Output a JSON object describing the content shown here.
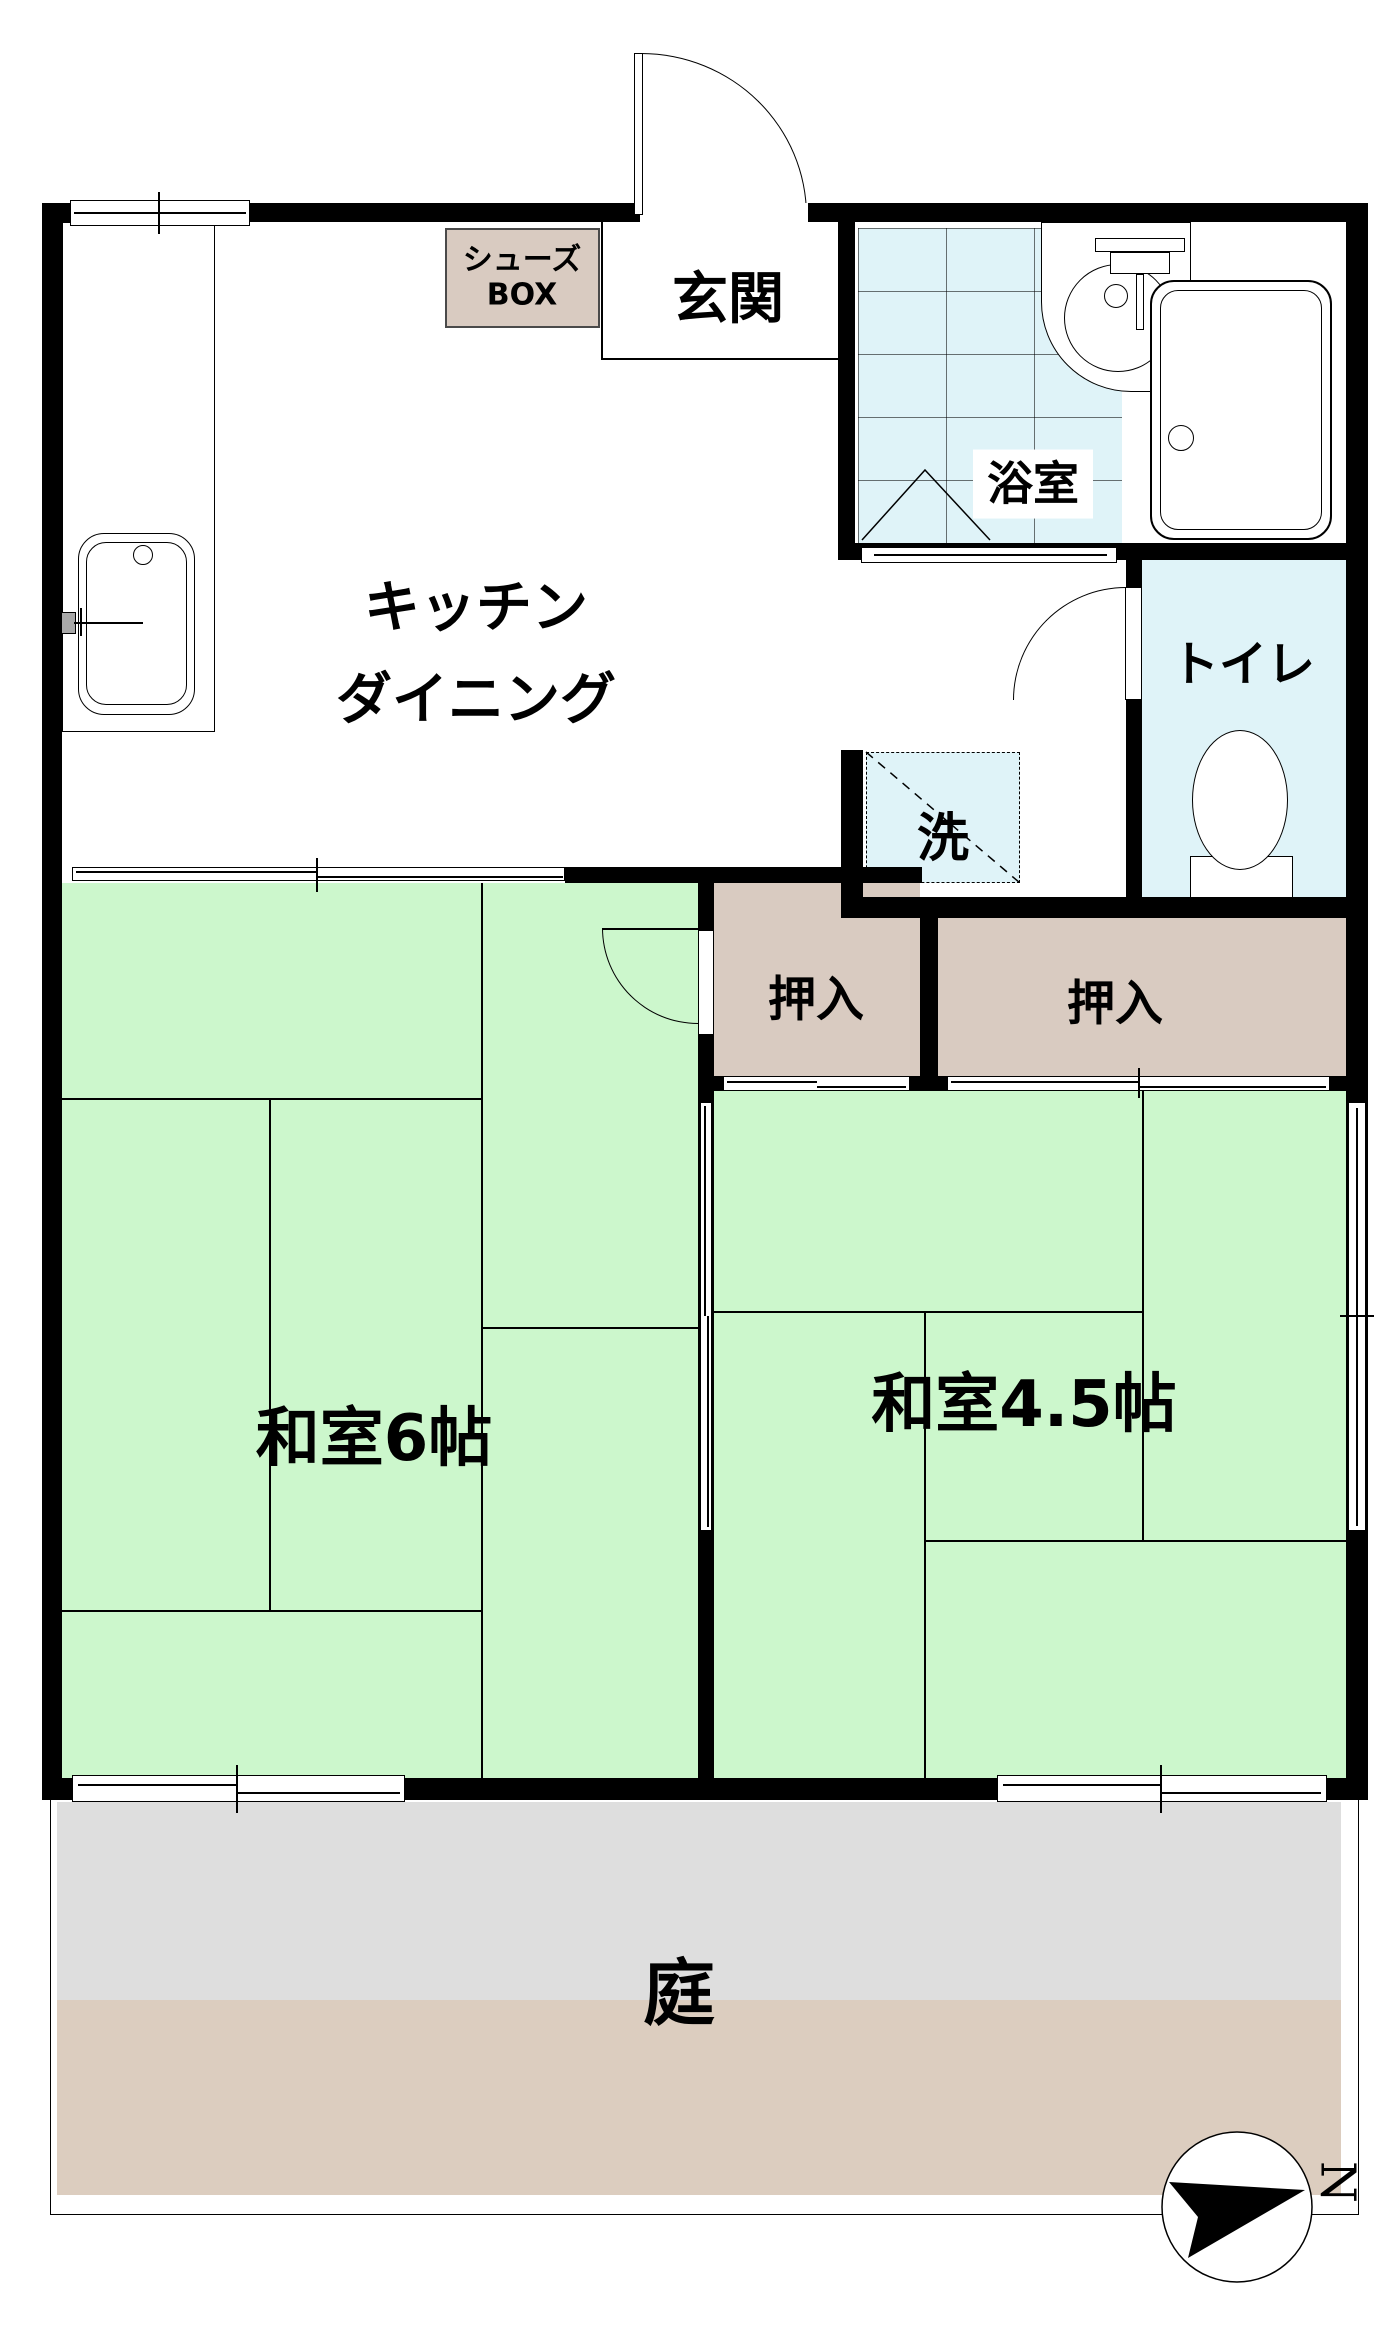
{
  "plan": {
    "rooms": {
      "genkan": {
        "label": "玄関"
      },
      "shoes_box": {
        "line1": "シューズ",
        "line2": "BOX"
      },
      "bathroom": {
        "label": "浴室"
      },
      "toilet": {
        "label": "トイレ"
      },
      "kitchen": {
        "line1": "キッチン",
        "line2": "ダイニング"
      },
      "laundry": {
        "label": "洗"
      },
      "closet_left": {
        "label": "押入"
      },
      "closet_right": {
        "label": "押入"
      },
      "washitsu_6": {
        "label": "和室6帖"
      },
      "washitsu_45": {
        "label": "和室4.5帖"
      },
      "garden": {
        "label": "庭"
      }
    },
    "compass": {
      "north_label": "N"
    },
    "colors": {
      "wall": "#000000",
      "tatami_green": "#ccf7cc",
      "tile_cyan": "#dff3f8",
      "closet_beige": "#d9cbc1",
      "shoes_box_beige": "#d9cbc1",
      "garden_concrete": "#dedede",
      "garden_soil": "#dccdbf",
      "faucet_gray": "#a8a8a8"
    }
  }
}
